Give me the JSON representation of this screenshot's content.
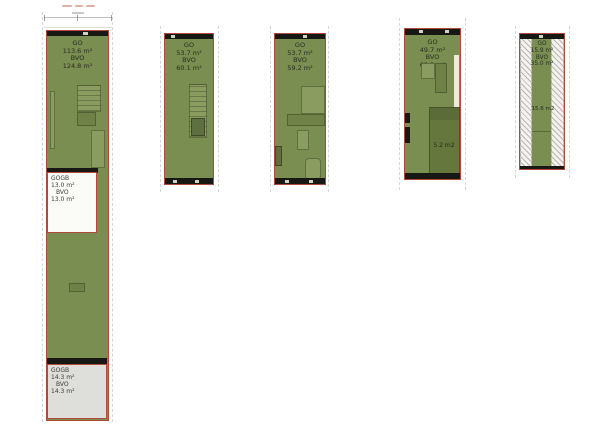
{
  "sheet": {
    "type": "floorplan-drawing",
    "background": "#ffffff"
  },
  "colors": {
    "plan_fill_green": "#7b8e51",
    "plan_border_red": "#b2493d",
    "wall_black": "#171714",
    "fixture_light_green": "#8b9c60",
    "fixture_dark_green": "#5f7040",
    "dark_room_green": "#66773e",
    "gogb_white_box": "#fbfbf8",
    "gogb_gray_box": "#dededb",
    "label_text": "#272c1e"
  },
  "plans": [
    {
      "name": "unit-1",
      "area_label": {
        "go_label": "GO",
        "go_value": "113.6 m²",
        "bvo_label": "BVO",
        "bvo_value": "124.8 m²"
      },
      "sub_areas": [
        {
          "go_label": "GOGB",
          "go_value": "13.0 m²",
          "bvo_label": "BVO",
          "bvo_value": "13.0 m²"
        },
        {
          "go_label": "GOGB",
          "go_value": "14.3 m²",
          "bvo_label": "BVO",
          "bvo_value": "14.3 m²"
        }
      ]
    },
    {
      "name": "unit-2",
      "area_label": {
        "go_label": "GO",
        "go_value": "53.7 m²",
        "bvo_label": "BVO",
        "bvo_value": "60.1 m²"
      }
    },
    {
      "name": "unit-3",
      "area_label": {
        "go_label": "GO",
        "go_value": "53.7 m²",
        "bvo_label": "BVO",
        "bvo_value": "59.2 m²"
      }
    },
    {
      "name": "unit-4",
      "area_label": {
        "go_label": "GO",
        "go_value": "49.7 m²",
        "bvo_label": "BVO",
        "bvo_value": "63.3 m²"
      },
      "room_label": "5.2 m2"
    },
    {
      "name": "unit-5",
      "area_label": {
        "go_label": "GO",
        "go_value": "15.9 m²",
        "bvo_label": "BVO",
        "bvo_value": "35.0 m²"
      },
      "room_label": "15.6 m2"
    }
  ]
}
